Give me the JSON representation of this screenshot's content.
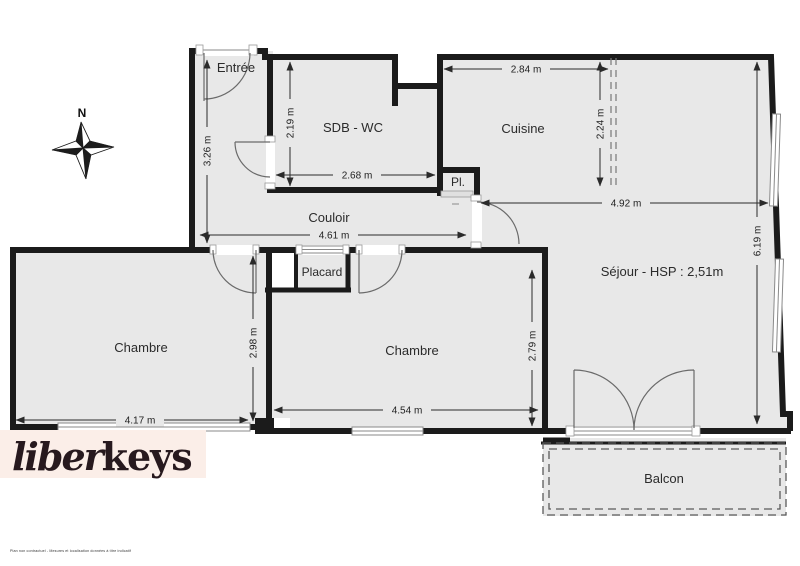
{
  "colors": {
    "wall": "#1b1b1b",
    "room_fill": "#e8e8e8",
    "dimension": "#2a2a2a",
    "logo_background": "#fbeee8",
    "logo_text": "#27191e"
  },
  "compass": {
    "label": "N"
  },
  "rooms": {
    "entree": "Entrée",
    "sdb_wc": "SDB - WC",
    "cuisine": "Cuisine",
    "pl": "Pl.",
    "couloir": "Couloir",
    "placard": "Placard",
    "chambre_1": "Chambre",
    "chambre_2": "Chambre",
    "sejour": "Séjour - HSP : 2,51m",
    "balcon": "Balcon"
  },
  "dimensions": {
    "entree_length": "3.26 m",
    "sdb_height": "2.19 m",
    "sdb_width": "2.68 m",
    "cuisine_width": "2.84 m",
    "cuisine_depth": "2.24 m",
    "sejour_width": "4.92 m",
    "sejour_height": "6.19 m",
    "couloir_length": "4.61 m",
    "chambre1_height": "2.98 m",
    "chambre1_width": "4.17 m",
    "chambre2_width": "4.54 m",
    "chambre2_height": "2.79 m"
  },
  "logo": {
    "script_part": "liber",
    "bold_part": "keys"
  },
  "footer": {
    "disclaimer": "Plan non contractuel - Mesures et localisation données à titre indicatif"
  }
}
